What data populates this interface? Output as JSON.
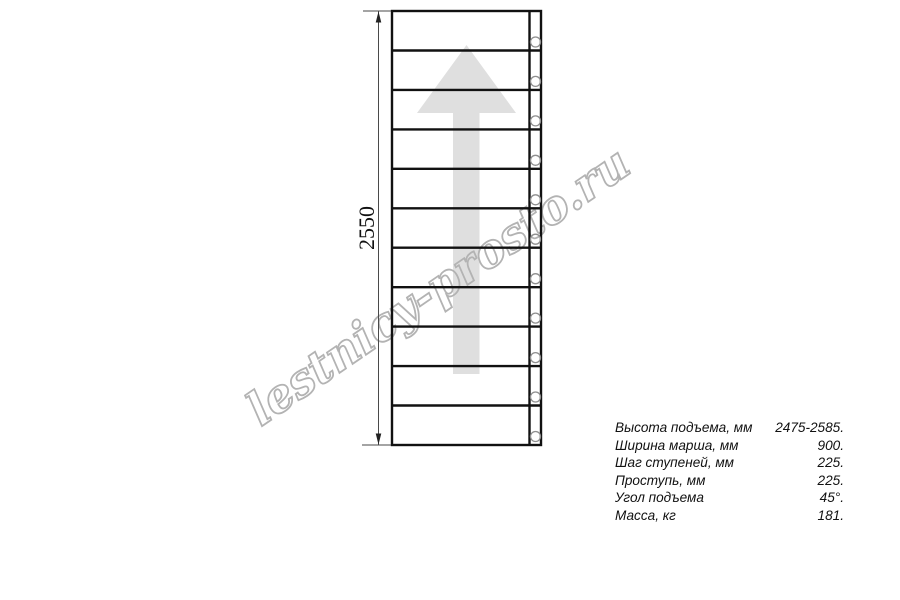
{
  "drawing": {
    "dimension_label": "2550",
    "watermark_text": "lestnicy-prosto.ru",
    "colors": {
      "main_line": "#111111",
      "thin_line": "#4a4a4a",
      "arrow_fill": "#dfdfdf",
      "watermark_stroke": "#b3b3b3",
      "circle_stroke": "#8f8f8f"
    }
  },
  "specs": {
    "rows": [
      {
        "label": "Высота подъема, мм",
        "value": "2475-2585."
      },
      {
        "label": "Ширина марша, мм",
        "value": "900."
      },
      {
        "label": "Шаг ступеней, мм",
        "value": "225."
      },
      {
        "label": "Проступь, мм",
        "value": "225."
      },
      {
        "label": "Угол подъема",
        "value": "45°."
      },
      {
        "label": "Масса, кг",
        "value": "181."
      }
    ]
  }
}
